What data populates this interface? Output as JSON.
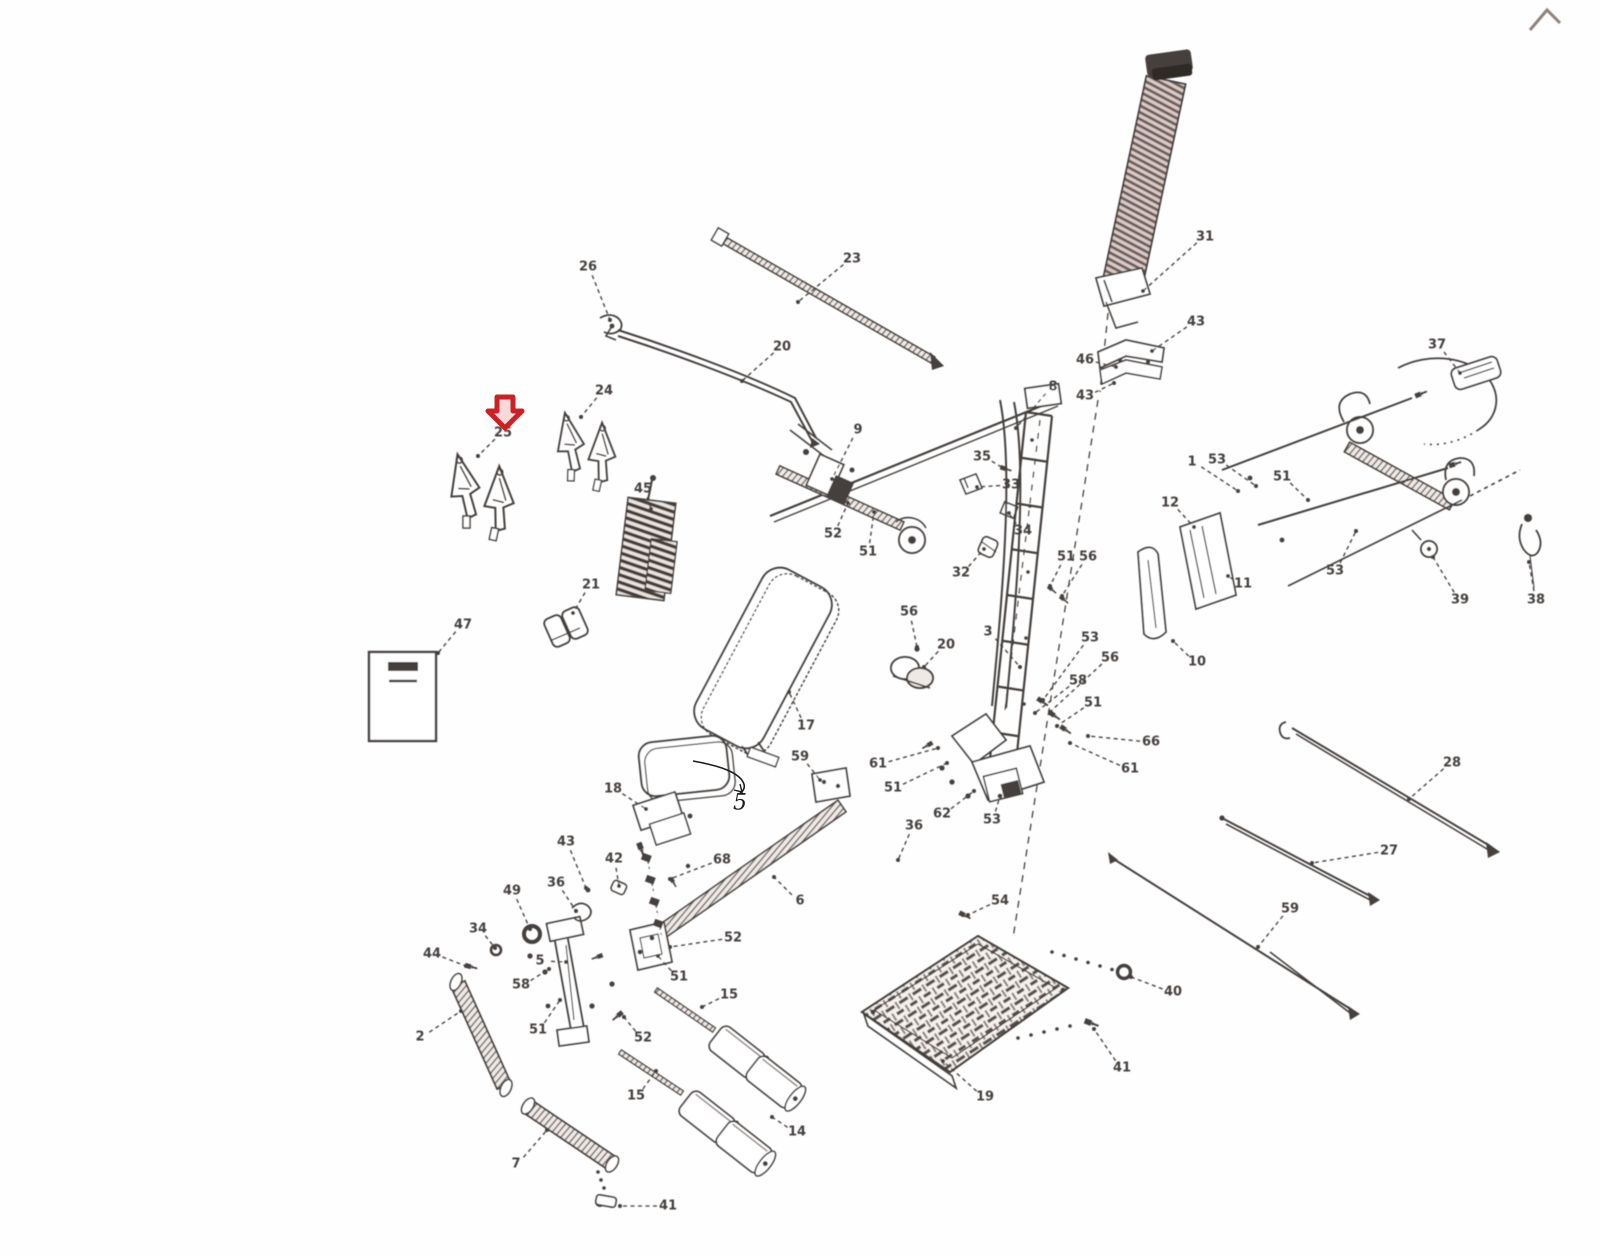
{
  "diagram": {
    "kind": "exploded-parts-diagram",
    "background": "#fefefe",
    "ink": "#443f3c",
    "ink_light": "#8d827e",
    "marker": {
      "type": "red-down-arrow",
      "color": "#ce2024",
      "fill": "#f6d9d8",
      "x": 505,
      "y": 412,
      "points_to_part": "25"
    },
    "handwritten_note": {
      "text": "5",
      "x": 740,
      "y": 803,
      "color": "#1c1c1c"
    },
    "labels": [
      {
        "t": "31",
        "x": 1205,
        "y": 237,
        "tx": 1143,
        "ty": 291
      },
      {
        "t": "43",
        "x": 1196,
        "y": 322,
        "tx": 1152,
        "ty": 351
      },
      {
        "t": "46",
        "x": 1085,
        "y": 360,
        "tx": 1116,
        "ty": 367
      },
      {
        "t": "43",
        "x": 1085,
        "y": 396,
        "tx": 1114,
        "ty": 383
      },
      {
        "t": "8",
        "x": 1053,
        "y": 387,
        "tx": 1016,
        "ty": 428
      },
      {
        "t": "23",
        "x": 852,
        "y": 259,
        "tx": 798,
        "ty": 302
      },
      {
        "t": "26",
        "x": 588,
        "y": 267,
        "tx": 610,
        "ty": 320
      },
      {
        "t": "20",
        "x": 782,
        "y": 347,
        "tx": 742,
        "ty": 381
      },
      {
        "t": "24",
        "x": 604,
        "y": 391,
        "tx": 581,
        "ty": 417
      },
      {
        "t": "25",
        "x": 503,
        "y": 433,
        "tx": 478,
        "ty": 456
      },
      {
        "t": "45",
        "x": 643,
        "y": 489,
        "tx": 651,
        "ty": 509
      },
      {
        "t": "21",
        "x": 591,
        "y": 585,
        "tx": 573,
        "ty": 613
      },
      {
        "t": "47",
        "x": 463,
        "y": 625,
        "tx": 438,
        "ty": 653
      },
      {
        "t": "9",
        "x": 858,
        "y": 430,
        "tx": 832,
        "ty": 479
      },
      {
        "t": "52",
        "x": 833,
        "y": 534,
        "tx": 848,
        "ty": 503
      },
      {
        "t": "51",
        "x": 868,
        "y": 552,
        "tx": 874,
        "ty": 512
      },
      {
        "t": "35",
        "x": 982,
        "y": 457,
        "tx": 1003,
        "ty": 468
      },
      {
        "t": "33",
        "x": 1011,
        "y": 485,
        "tx": 977,
        "ty": 487
      },
      {
        "t": "34",
        "x": 1023,
        "y": 531,
        "tx": 1009,
        "ty": 513
      },
      {
        "t": "32",
        "x": 961,
        "y": 573,
        "tx": 984,
        "ty": 549
      },
      {
        "t": "56",
        "x": 909,
        "y": 612,
        "tx": 917,
        "ty": 647
      },
      {
        "t": "20",
        "x": 946,
        "y": 645,
        "tx": 924,
        "ty": 667
      },
      {
        "t": "3",
        "x": 988,
        "y": 632,
        "tx": 1020,
        "ty": 667
      },
      {
        "t": "53",
        "x": 1090,
        "y": 638,
        "tx": 1043,
        "ty": 700
      },
      {
        "t": "56",
        "x": 1110,
        "y": 658,
        "tx": 1050,
        "ty": 712
      },
      {
        "t": "58",
        "x": 1078,
        "y": 681,
        "tx": 1035,
        "ty": 713
      },
      {
        "t": "51",
        "x": 1093,
        "y": 703,
        "tx": 1057,
        "ty": 726
      },
      {
        "t": "66",
        "x": 1151,
        "y": 742,
        "tx": 1088,
        "ty": 736
      },
      {
        "t": "61",
        "x": 1130,
        "y": 769,
        "tx": 1070,
        "ty": 743
      },
      {
        "t": "51",
        "x": 1066,
        "y": 557,
        "tx": 1050,
        "ty": 586
      },
      {
        "t": "56",
        "x": 1088,
        "y": 557,
        "tx": 1062,
        "ty": 596
      },
      {
        "t": "61",
        "x": 878,
        "y": 764,
        "tx": 938,
        "ty": 748
      },
      {
        "t": "51",
        "x": 893,
        "y": 788,
        "tx": 947,
        "ty": 763
      },
      {
        "t": "62",
        "x": 942,
        "y": 814,
        "tx": 974,
        "ty": 791
      },
      {
        "t": "53",
        "x": 992,
        "y": 820,
        "tx": 1000,
        "ty": 796
      },
      {
        "t": "36",
        "x": 914,
        "y": 826,
        "tx": 898,
        "ty": 860
      },
      {
        "t": "12",
        "x": 1170,
        "y": 503,
        "tx": 1194,
        "ty": 527
      },
      {
        "t": "10",
        "x": 1197,
        "y": 662,
        "tx": 1173,
        "ty": 641
      },
      {
        "t": "11",
        "x": 1243,
        "y": 584,
        "tx": 1228,
        "ty": 576
      },
      {
        "t": "1",
        "x": 1192,
        "y": 462,
        "tx": 1238,
        "ty": 491
      },
      {
        "t": "53",
        "x": 1217,
        "y": 460,
        "tx": 1256,
        "ty": 486
      },
      {
        "t": "51",
        "x": 1282,
        "y": 477,
        "tx": 1308,
        "ty": 500
      },
      {
        "t": "37",
        "x": 1437,
        "y": 345,
        "tx": 1460,
        "ty": 373
      },
      {
        "t": "39",
        "x": 1460,
        "y": 600,
        "tx": 1433,
        "ty": 557
      },
      {
        "t": "38",
        "x": 1536,
        "y": 600,
        "tx": 1529,
        "ty": 562
      },
      {
        "t": "53",
        "x": 1335,
        "y": 571,
        "tx": 1356,
        "ty": 531
      },
      {
        "t": "28",
        "x": 1452,
        "y": 763,
        "tx": 1409,
        "ty": 799
      },
      {
        "t": "27",
        "x": 1389,
        "y": 851,
        "tx": 1312,
        "ty": 863
      },
      {
        "t": "59",
        "x": 1290,
        "y": 909,
        "tx": 1258,
        "ty": 947
      },
      {
        "t": "54",
        "x": 1000,
        "y": 901,
        "tx": 968,
        "ty": 915
      },
      {
        "t": "40",
        "x": 1173,
        "y": 992,
        "tx": 1131,
        "ty": 977
      },
      {
        "t": "41",
        "x": 1122,
        "y": 1068,
        "tx": 1094,
        "ty": 1029
      },
      {
        "t": "19",
        "x": 985,
        "y": 1097,
        "tx": 943,
        "ty": 1061
      },
      {
        "t": "17",
        "x": 806,
        "y": 726,
        "tx": 789,
        "ty": 692
      },
      {
        "t": "18",
        "x": 613,
        "y": 789,
        "tx": 646,
        "ty": 809
      },
      {
        "t": "59",
        "x": 800,
        "y": 757,
        "tx": 820,
        "ty": 780
      },
      {
        "t": "6",
        "x": 800,
        "y": 901,
        "tx": 774,
        "ty": 877
      },
      {
        "t": "52",
        "x": 733,
        "y": 938,
        "tx": 670,
        "ty": 947
      },
      {
        "t": "51",
        "x": 679,
        "y": 977,
        "tx": 658,
        "ty": 956
      },
      {
        "t": "15",
        "x": 729,
        "y": 995,
        "tx": 702,
        "ty": 1007
      },
      {
        "t": "15",
        "x": 636,
        "y": 1096,
        "tx": 656,
        "ty": 1071
      },
      {
        "t": "52",
        "x": 643,
        "y": 1038,
        "tx": 624,
        "ty": 1017
      },
      {
        "t": "51",
        "x": 538,
        "y": 1030,
        "tx": 560,
        "ty": 1000
      },
      {
        "t": "58",
        "x": 521,
        "y": 985,
        "tx": 549,
        "ty": 969
      },
      {
        "t": "5",
        "x": 540,
        "y": 961,
        "tx": 566,
        "ty": 962
      },
      {
        "t": "68",
        "x": 722,
        "y": 860,
        "tx": 670,
        "ty": 879
      },
      {
        "t": "7",
        "x": 516,
        "y": 1164,
        "tx": 547,
        "ty": 1130
      },
      {
        "t": "41",
        "x": 668,
        "y": 1206,
        "tx": 620,
        "ty": 1206
      },
      {
        "t": "14",
        "x": 797,
        "y": 1132,
        "tx": 772,
        "ty": 1117
      },
      {
        "t": "2",
        "x": 420,
        "y": 1037,
        "tx": 461,
        "ty": 1011
      },
      {
        "t": "44",
        "x": 432,
        "y": 954,
        "tx": 466,
        "ty": 966
      },
      {
        "t": "34",
        "x": 478,
        "y": 929,
        "tx": 495,
        "ty": 948
      },
      {
        "t": "49",
        "x": 512,
        "y": 891,
        "tx": 530,
        "ty": 929
      },
      {
        "t": "36",
        "x": 556,
        "y": 883,
        "tx": 576,
        "ty": 911
      },
      {
        "t": "43",
        "x": 566,
        "y": 842,
        "tx": 586,
        "ty": 888
      },
      {
        "t": "42",
        "x": 614,
        "y": 859,
        "tx": 619,
        "ty": 886
      }
    ]
  }
}
